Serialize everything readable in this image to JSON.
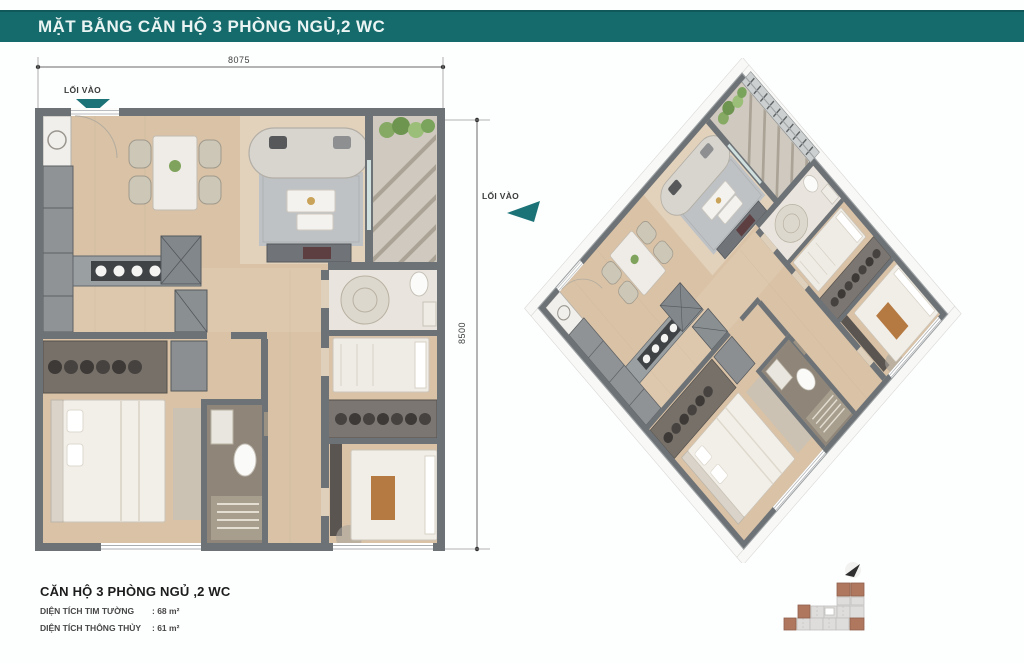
{
  "header": {
    "title": "MẶT BẰNG CĂN HỘ 3 PHÒNG NGỦ,2 WC"
  },
  "plan2d": {
    "entry_label": "LỐI VÀO",
    "width_dim": "8075",
    "height_dim": "8500"
  },
  "plan3d": {
    "entry_label": "LỐI VÀO"
  },
  "info": {
    "title": "CĂN HỘ 3 PHÒNG NGỦ ,2 WC",
    "rows": [
      {
        "label": "DIỆN TÍCH TIM TƯỜNG",
        "value": ": 68 m²"
      },
      {
        "label": "DIỆN TÍCH THÔNG THỦY",
        "value": ": 61 m²"
      }
    ]
  },
  "icons": {
    "entry_arrow": "teal-triangle-entry-arrow",
    "keyplan_arrow": "keyplan-location-arrow"
  },
  "colors": {
    "header_bar": "#156a6c",
    "accent_teal": "#1b7377",
    "wall_gray": "#6d7276",
    "floor_wood": "#d9c2a6",
    "keyplan_highlight": "#b0775f",
    "keyplan_block": "#dedddb",
    "text_dark": "#2f2f2f"
  }
}
